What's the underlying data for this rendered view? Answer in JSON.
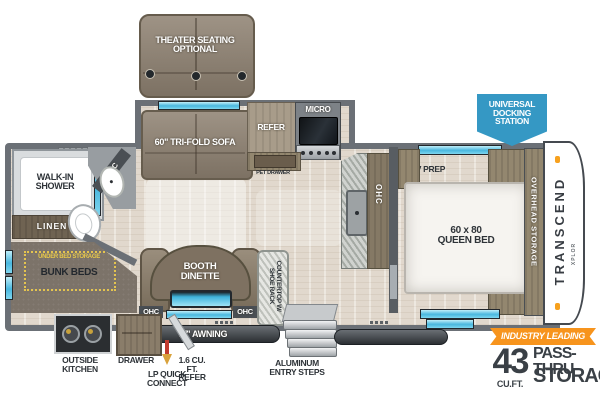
{
  "floorplan": {
    "brand": "TRANSCEND",
    "brand_sub": "XPLOR",
    "badges": {
      "docking": "UNIVERSAL DOCKING STATION",
      "industry_leading": "INDUSTRY LEADING",
      "storage_number": "43",
      "storage_unit": "CU.FT.",
      "storage_line1": "PASS-THRU",
      "storage_line2": "STORAGE"
    },
    "living": {
      "theater_seating": "THEATER SEATING OPTIONAL",
      "sofa": "60\" TRI-FOLD SOFA",
      "booth_dinette": "BOOTH DINETTE",
      "ohc_left": "OHC",
      "ohc_right": "OHC",
      "countertop": "COUNTERTOP W/ SHOE RACK"
    },
    "kitchen": {
      "refer": "REFER",
      "micro": "MICRO",
      "pet_drawer": "PET DRAWER",
      "ohc": "OHC"
    },
    "bath": {
      "walk_in_shower": "WALK-IN SHOWER",
      "linen": "LINEN",
      "ohc": "OHC"
    },
    "bunk": {
      "under_bed_storage": "UNDER BED STORAGE",
      "bunk_beds": "BUNK BEDS"
    },
    "bedroom": {
      "tv_prep": "TV PREP",
      "queen_bed": "60 x 80 QUEEN BED",
      "overhead_storage": "OVERHEAD STORAGE"
    },
    "exterior": {
      "awning": "17' AWNING",
      "lp_quick_connect": "LP QUICK CONNECT",
      "entry_steps": "ALUMINUM ENTRY STEPS",
      "outside_kitchen": "OUTSIDE KITCHEN",
      "drawer": "DRAWER",
      "mini_refer": "1.6 CU. FT. REFER"
    },
    "colors": {
      "accent_orange": "#f7941d",
      "badge_blue": "#3598c4",
      "window_blue": "#5fc6e8",
      "wall_gray": "#6b7076"
    }
  }
}
